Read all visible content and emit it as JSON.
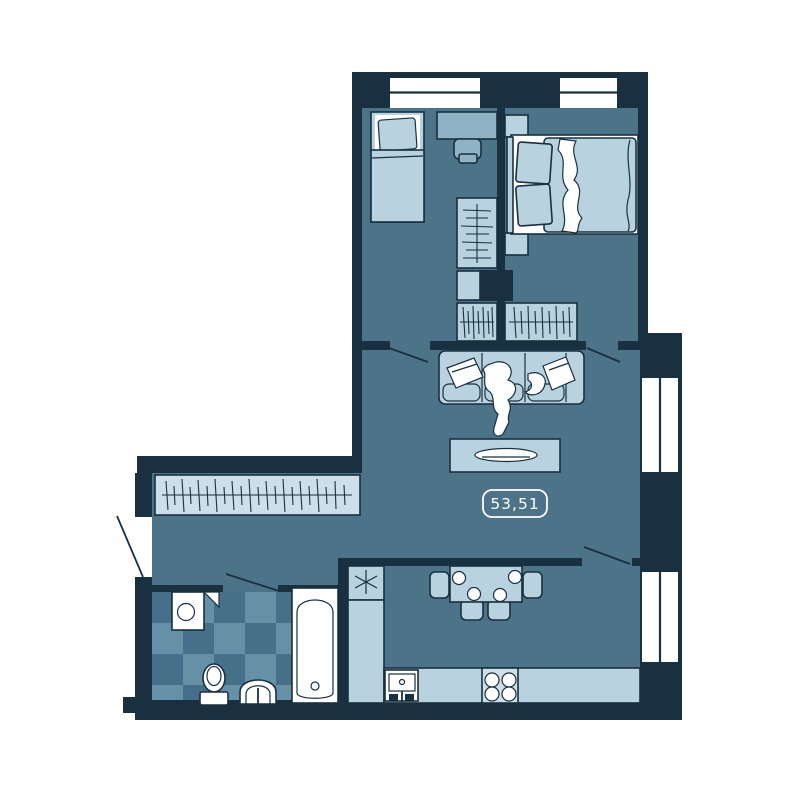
{
  "floor_plan": {
    "area_label": "53,51"
  },
  "palette": {
    "background": "#ffffff",
    "wall": "#18303f",
    "floor": "#4d7389",
    "furniture_light": "#b8d2df",
    "furniture_medium": "#8fb2c5",
    "furniture_pale": "#cde0e9",
    "bathroom_tile_dark": "#46708a",
    "bathroom_tile_light": "#6590a5",
    "fixture_white": "#ffffff",
    "label_text": "#ffffff"
  },
  "icons": {
    "freezer_star": "✳"
  }
}
